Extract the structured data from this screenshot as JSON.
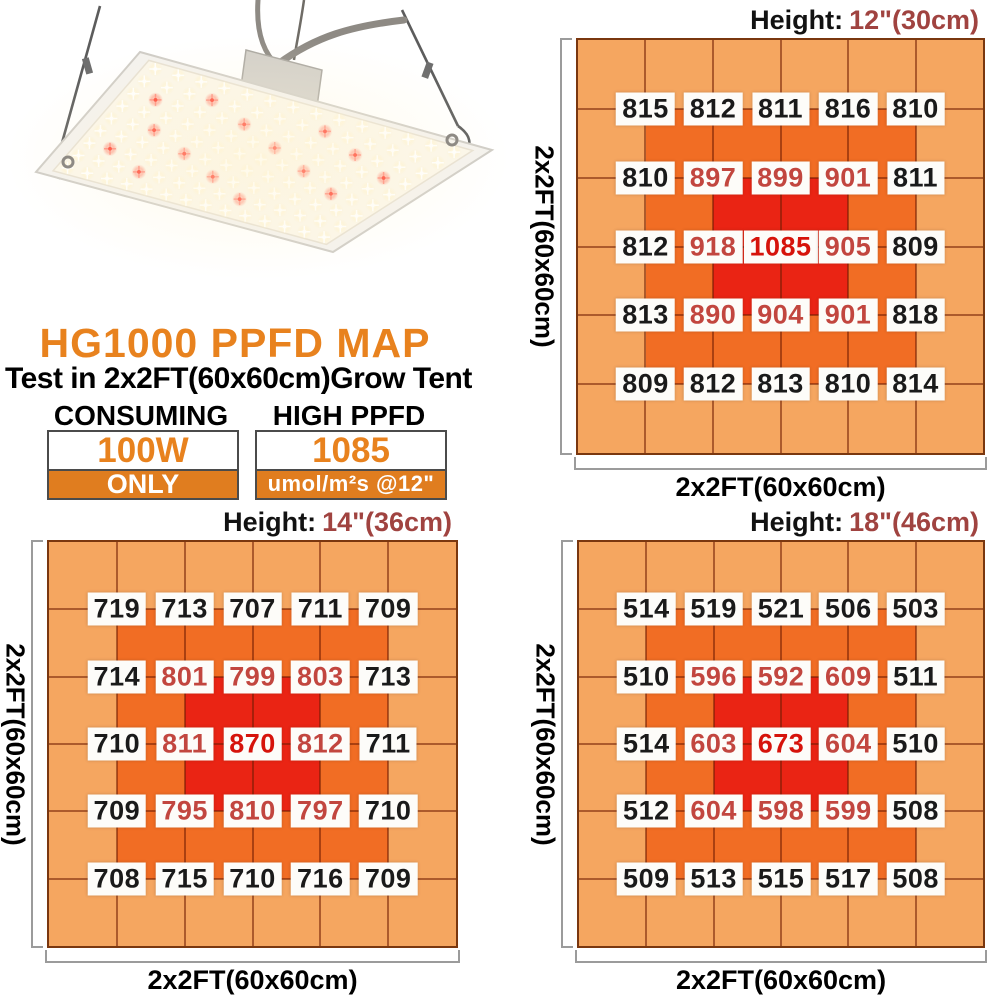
{
  "title_block": {
    "title": "HG1000 PPFD MAP",
    "subtitle": "Test in 2x2FT(60x60cm)Grow Tent"
  },
  "specs": {
    "consuming": {
      "header": "CONSUMING",
      "value": "100W",
      "note": "ONLY"
    },
    "high_ppfd": {
      "header": "HIGH PPFD",
      "value": "1085",
      "note": "umol/m²s @12\""
    }
  },
  "photo": {
    "label": "HG1000 LED grow light panel hanging on steel cables"
  },
  "chart_data": [
    {
      "type": "heatmap",
      "id": "height-12in",
      "height_label": "Height:",
      "height_value": "12\"(30cm)",
      "xlabel": "2x2FT(60x60cm)",
      "ylabel": "2x2FT(60x60cm)",
      "layout": "6x6 colored cells, 5x5 PPFD sample points at grid intersections",
      "values": [
        [
          815,
          812,
          811,
          816,
          810
        ],
        [
          810,
          897,
          899,
          901,
          811
        ],
        [
          812,
          918,
          1085,
          905,
          809
        ],
        [
          813,
          890,
          904,
          901,
          818
        ],
        [
          809,
          812,
          813,
          810,
          814
        ]
      ]
    },
    {
      "type": "heatmap",
      "id": "height-14in",
      "height_label": "Height:",
      "height_value": "14\"(36cm)",
      "xlabel": "2x2FT(60x60cm)",
      "ylabel": "2x2FT(60x60cm)",
      "layout": "6x6 colored cells, 5x5 PPFD sample points at grid intersections",
      "values": [
        [
          719,
          713,
          707,
          711,
          709
        ],
        [
          714,
          801,
          799,
          803,
          713
        ],
        [
          710,
          811,
          870,
          812,
          711
        ],
        [
          709,
          795,
          810,
          797,
          710
        ],
        [
          708,
          715,
          710,
          716,
          709
        ]
      ]
    },
    {
      "type": "heatmap",
      "id": "height-18in",
      "height_label": "Height:",
      "height_value": "18\"(46cm)",
      "xlabel": "2x2FT(60x60cm)",
      "ylabel": "2x2FT(60x60cm)",
      "layout": "6x6 colored cells, 5x5 PPFD sample points at grid intersections",
      "values": [
        [
          514,
          519,
          521,
          506,
          503
        ],
        [
          510,
          596,
          592,
          609,
          511
        ],
        [
          514,
          603,
          673,
          604,
          510
        ],
        [
          512,
          604,
          598,
          599,
          508
        ],
        [
          509,
          513,
          515,
          517,
          508
        ]
      ]
    }
  ],
  "colors": {
    "accent_orange": "#e8821e",
    "bar_orange": "#e07d1f",
    "cell_light": "#f5a660",
    "cell_mid": "#f16d24",
    "cell_hot": "#ea2414",
    "value_black": "#1a1a1a",
    "value_crimson": "#c2463f",
    "value_peak": "#d6130b",
    "height_value_color": "#a04340",
    "grid_line": "rgba(112,28,2,0.55)",
    "grid_border": "#7a370f",
    "bracket_gray": "#9b9b9b"
  }
}
